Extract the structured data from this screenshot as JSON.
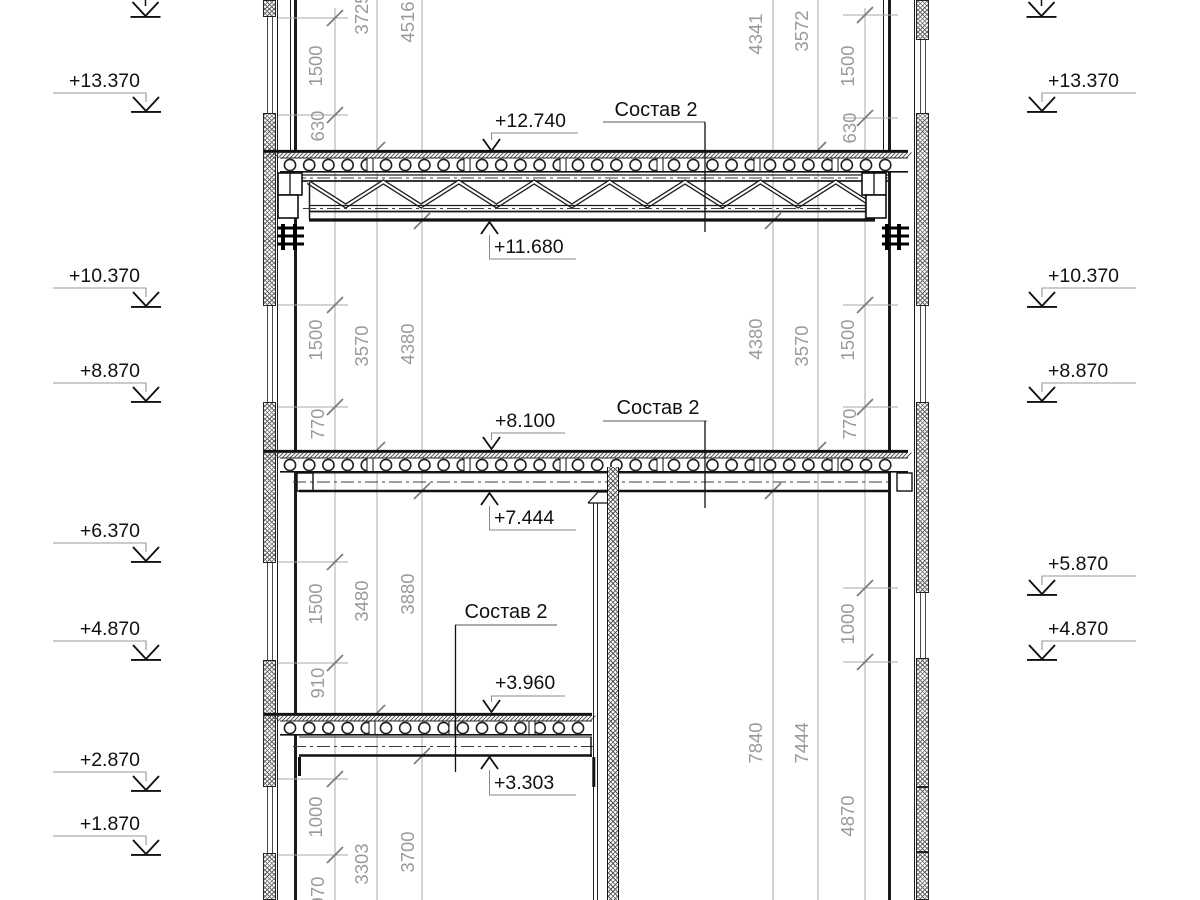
{
  "drawing": {
    "composition_label": "Состав 2",
    "elevation_marks_left": [
      "+13.370",
      "+10.370",
      "+8.870",
      "+6.370",
      "+4.870",
      "+2.870",
      "+1.870"
    ],
    "elevation_marks_right": [
      "+13.370",
      "+10.370",
      "+8.870",
      "+5.870",
      "+4.870"
    ],
    "level_callouts": [
      "+12.740",
      "+11.680",
      "+8.100",
      "+7.444",
      "+3.960",
      "+3.303"
    ],
    "dim_left": [
      "1500",
      "630",
      "3725",
      "4516",
      "1500",
      "770",
      "3570",
      "4380",
      "1500",
      "910",
      "3480",
      "3880",
      "1000",
      "970",
      "3303",
      "3700"
    ],
    "dim_right": [
      "4341",
      "3572",
      "1500",
      "630",
      "4380",
      "3570",
      "1500",
      "770",
      "1000",
      "7840",
      "7444",
      "4870"
    ],
    "colors": {
      "line": "#1a1a1a",
      "dim": "#9a9a9a",
      "background": "#ffffff"
    }
  }
}
